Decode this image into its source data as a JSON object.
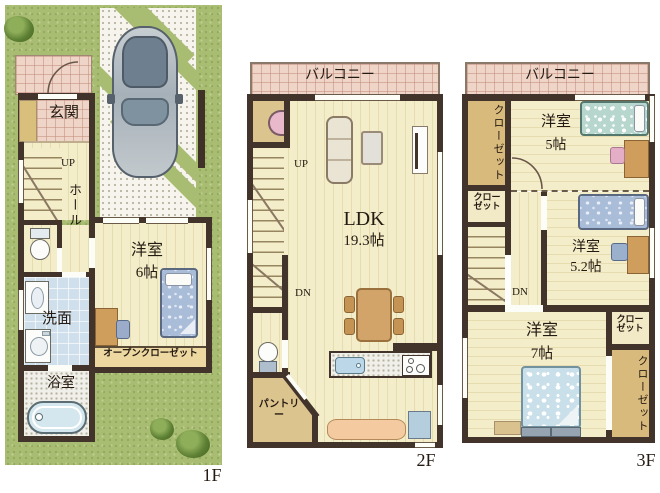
{
  "floor1": {
    "label": "1F",
    "entrance": "玄関",
    "hall": "ホール",
    "up": "UP",
    "room6_name": "洋室",
    "room6_size": "6帖",
    "washroom": "洗面",
    "bathroom": "浴室",
    "open_closet": "オープンクローゼット"
  },
  "floor2": {
    "label": "2F",
    "balcony": "バルコニー",
    "up": "UP",
    "dn": "DN",
    "ldk_name": "LDK",
    "ldk_size": "19.3帖",
    "pantry": "パントリー"
  },
  "floor3": {
    "label": "3F",
    "balcony": "バルコニー",
    "closet_left": "クローゼット",
    "closet_top": "クロー\nゼット",
    "room5_name": "洋室",
    "room5_size": "5帖",
    "dn": "DN",
    "room52_name": "洋室",
    "room52_size": "5.2帖",
    "room7_name": "洋室",
    "room7_size": "7帖",
    "closet_mid": "クロー\nゼット",
    "closet_right": "クローゼット"
  },
  "colors": {
    "wall": "#42342a",
    "lawn": "#a9bd72",
    "floor_cream": "#f3edc9",
    "tile_pink": "#eed5c8",
    "water_blue": "#cfe0ec",
    "closet_tan": "#d9ba7d"
  }
}
